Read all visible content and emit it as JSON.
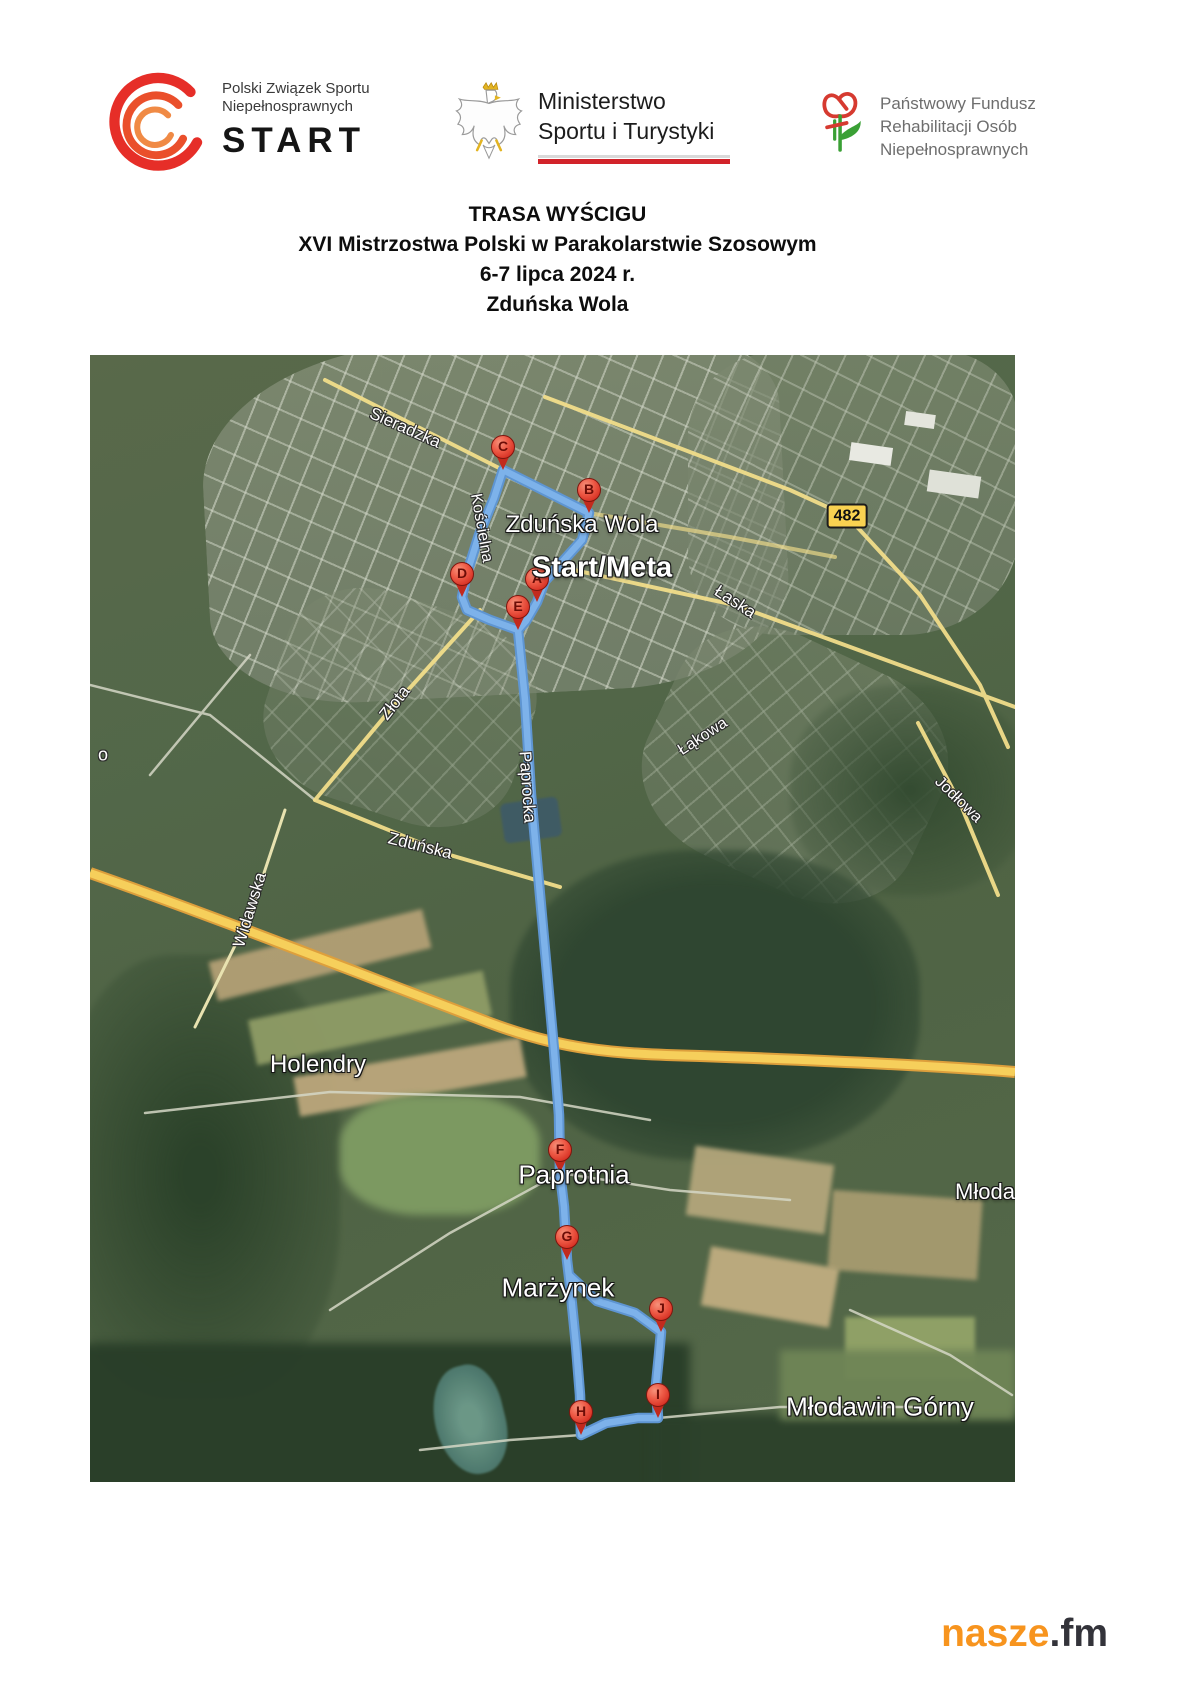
{
  "header": {
    "start_logo": {
      "line1": "Polski Związek Sportu",
      "line2": "Niepełnosprawnych",
      "name": "START"
    },
    "ministry": {
      "line1": "Ministerstwo",
      "line2": "Sportu i Turystyki"
    },
    "pfron": {
      "line1": "Państwowy Fundusz",
      "line2": "Rehabilitacji Osób",
      "line3": "Niepełnosprawnych"
    }
  },
  "title": {
    "line1": "TRASA WYŚCIGU",
    "line2": "XVI Mistrzostwa Polski w Parakolarstwie Szosowym",
    "line3": "6-7 lipca 2024 r.",
    "line4": "Zduńska Wola"
  },
  "map": {
    "route_color": "#7db2ea",
    "road_badge": {
      "text": "482",
      "x": 757,
      "y": 161
    },
    "markers": [
      {
        "letter": "A",
        "x": 447,
        "y": 247
      },
      {
        "letter": "B",
        "x": 499,
        "y": 158
      },
      {
        "letter": "C",
        "x": 413,
        "y": 115
      },
      {
        "letter": "D",
        "x": 372,
        "y": 242
      },
      {
        "letter": "E",
        "x": 428,
        "y": 275
      },
      {
        "letter": "F",
        "x": 470,
        "y": 818
      },
      {
        "letter": "G",
        "x": 477,
        "y": 905
      },
      {
        "letter": "H",
        "x": 491,
        "y": 1080
      },
      {
        "letter": "I",
        "x": 568,
        "y": 1063
      },
      {
        "letter": "J",
        "x": 571,
        "y": 977
      }
    ],
    "place_labels": [
      {
        "text": "Zduńska Wola",
        "x": 492,
        "y": 170,
        "size": 24,
        "bold": false
      },
      {
        "text": "Start/Meta",
        "x": 512,
        "y": 213,
        "size": 29,
        "bold": true
      },
      {
        "text": "Holendry",
        "x": 228,
        "y": 710,
        "size": 24,
        "bold": false
      },
      {
        "text": "Paprotnia",
        "x": 484,
        "y": 820,
        "size": 26,
        "bold": false
      },
      {
        "text": "Marżynek",
        "x": 468,
        "y": 933,
        "size": 26,
        "bold": false
      },
      {
        "text": "Młodawin Górny",
        "x": 790,
        "y": 1052,
        "size": 26,
        "bold": false
      },
      {
        "text": "Młoda",
        "x": 895,
        "y": 837,
        "size": 22,
        "bold": false
      }
    ],
    "street_labels": [
      {
        "text": "Sieradzka",
        "x": 315,
        "y": 73,
        "rot": 24,
        "size": 17
      },
      {
        "text": "Kościelna",
        "x": 391,
        "y": 173,
        "rot": 80,
        "size": 16
      },
      {
        "text": "Łaska",
        "x": 645,
        "y": 247,
        "rot": 33,
        "size": 17
      },
      {
        "text": "Złota",
        "x": 305,
        "y": 348,
        "rot": -52,
        "size": 17
      },
      {
        "text": "Łąkowa",
        "x": 613,
        "y": 382,
        "rot": -33,
        "size": 16
      },
      {
        "text": "Paprocka",
        "x": 437,
        "y": 432,
        "rot": 86,
        "size": 17
      },
      {
        "text": "Zduńska",
        "x": 330,
        "y": 491,
        "rot": 14,
        "size": 17
      },
      {
        "text": "Widawska",
        "x": 160,
        "y": 555,
        "rot": -73,
        "size": 17
      },
      {
        "text": "Jodłowa",
        "x": 868,
        "y": 445,
        "rot": 44,
        "size": 16
      },
      {
        "text": "o",
        "x": 13,
        "y": 400,
        "rot": 0,
        "size": 18
      }
    ]
  },
  "footer": {
    "brand_orange": "nasze",
    "brand_dark": ".fm"
  }
}
